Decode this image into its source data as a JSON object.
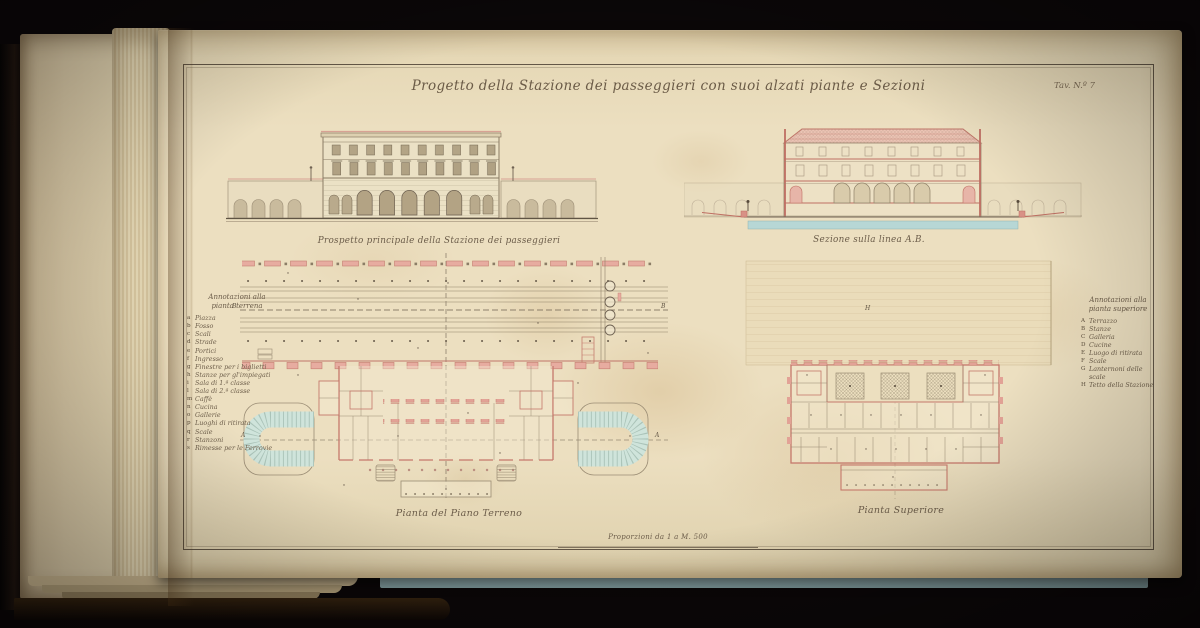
{
  "plate": {
    "title": "Progetto della Stazione dei passeggieri con suoi alzati piante e Sezioni",
    "sheet_label": "Tav. N.º 7",
    "captions": {
      "elevation": "Prospetto principale della Stazione dei passeggieri",
      "section": "Sezione sulla linea A.B.",
      "ground_plan": "Pianta del Piano Terreno",
      "upper_plan": "Pianta Superiore",
      "scale": "Proporzioni da 1 a M. 500"
    },
    "legend_left": {
      "title1": "Annotazioni alla",
      "title2": "pianta terrena",
      "items": [
        {
          "k": "a",
          "v": "Piazza"
        },
        {
          "k": "b",
          "v": "Fosso"
        },
        {
          "k": "c",
          "v": "Scali"
        },
        {
          "k": "d",
          "v": "Strade"
        },
        {
          "k": "e",
          "v": "Portici"
        },
        {
          "k": "f",
          "v": "Ingresso"
        },
        {
          "k": "g",
          "v": "Finestre per i biglietti"
        },
        {
          "k": "h",
          "v": "Stanze per gl'impiegati"
        },
        {
          "k": "i",
          "v": "Sala di 1.ª classe"
        },
        {
          "k": "l",
          "v": "Sala di 2.ª classe"
        },
        {
          "k": "m",
          "v": "Caffè"
        },
        {
          "k": "n",
          "v": "Cucina"
        },
        {
          "k": "o",
          "v": "Gallerie"
        },
        {
          "k": "p",
          "v": "Luoghi di ritirata"
        },
        {
          "k": "q",
          "v": "Scale"
        },
        {
          "k": "r",
          "v": "Stanzoni"
        },
        {
          "k": "s",
          "v": "Rimesse per le Ferrovie"
        }
      ]
    },
    "legend_right": {
      "title1": "Annotazioni alla",
      "title2": "pianta superiore",
      "items": [
        {
          "k": "A",
          "v": "Terrazzo"
        },
        {
          "k": "B",
          "v": "Stanze"
        },
        {
          "k": "C",
          "v": "Galleria"
        },
        {
          "k": "D",
          "v": "Cucine"
        },
        {
          "k": "E",
          "v": "Luogo di ritirata"
        },
        {
          "k": "F",
          "v": "Scale"
        },
        {
          "k": "G",
          "v": "Lanternoni delle scale"
        },
        {
          "k": "H",
          "v": "Tetto della Stazione"
        }
      ]
    },
    "drawing_labels": {
      "track_axis_left": "B",
      "track_axis_right": "B",
      "plan_axis_left": "A",
      "plan_axis_right": "A",
      "roof": "H"
    },
    "colors": {
      "paper": "#e9dcbd",
      "ink": "#6f6252",
      "wall_pink": "#e7aca0",
      "line_red": "#c0746a",
      "wash_blue": "#b7d7d5",
      "wash_teal": "#cfe4db"
    }
  }
}
